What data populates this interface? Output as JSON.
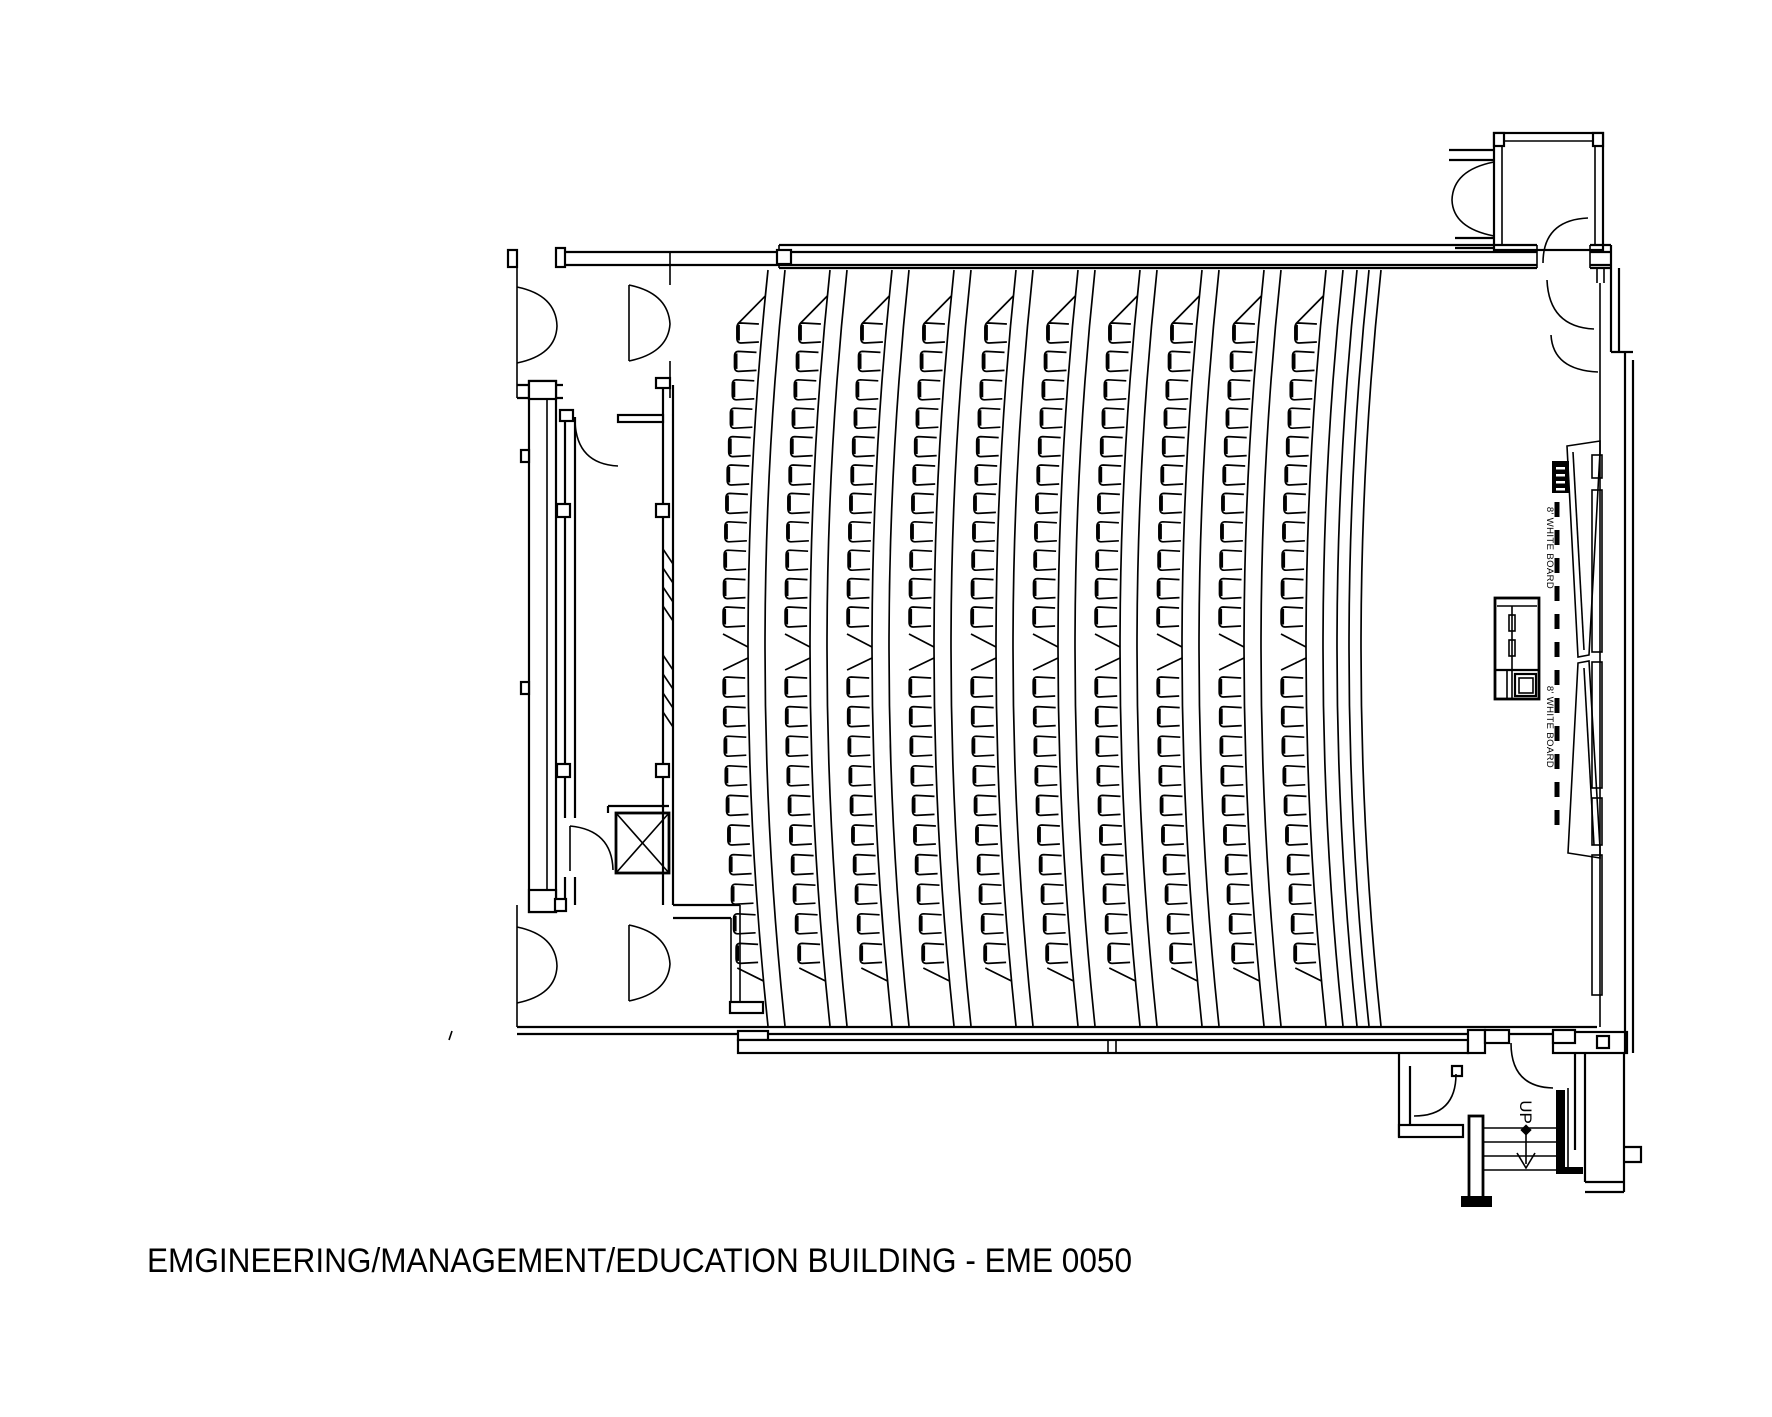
{
  "document": {
    "type": "architectural-floor-plan",
    "title": "EMGINEERING/MANAGEMENT/EDUCATION BUILDING - EME 0050"
  },
  "labels": {
    "whiteboard_upper": "8' WHITE BOARD",
    "whiteboard_lower": "8' WHITE BOARD",
    "stairs_direction": "UP"
  },
  "colors": {
    "ink": "#000000",
    "paper": "#ffffff"
  },
  "seating": {
    "columns": 10,
    "rows_upper": 11,
    "rows_lower": 10,
    "seats_per_column": 21,
    "total_seats": 210,
    "geometry": {
      "first_chair_x": 742,
      "column_pitch": 62,
      "chair_w": 24,
      "chair_h": 22,
      "upper_y0": 322,
      "upper_pitch": 28.4,
      "lower_y0": 676,
      "lower_pitch": 29.6,
      "band_offset": 26,
      "band_width": 17,
      "band_top": 270,
      "band_bottom": 1026,
      "mid_y": 648,
      "half_span": 378,
      "bulge": 20,
      "extra_aisle_arcs_x": [
        1357,
        1369,
        1381
      ]
    }
  },
  "features": [
    "double-entry-doors-top-left",
    "double-entry-doors-bottom-left",
    "service-corridor",
    "elevator-shaft",
    "window-band",
    "lectern",
    "whiteboard-line",
    "projection-screen",
    "entry-vestibule-top-right",
    "stairs-up-bottom-right"
  ]
}
